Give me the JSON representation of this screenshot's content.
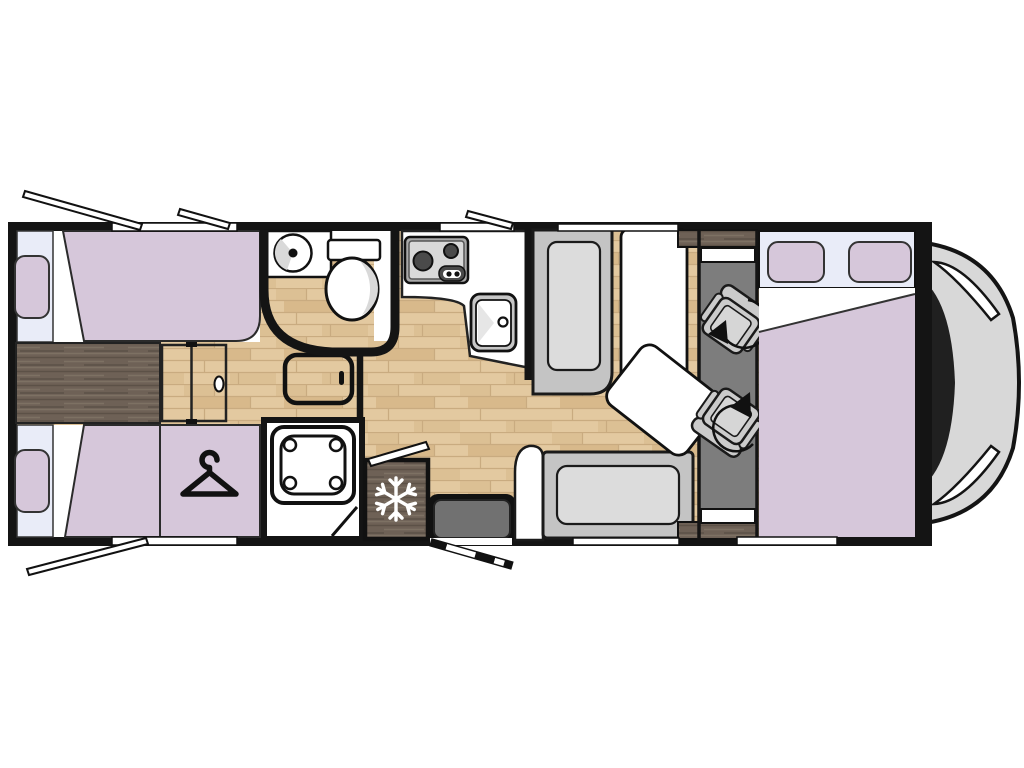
{
  "diagram": {
    "type": "motorhome-floor-plan",
    "view": "top-down",
    "vehicle_front": "right"
  },
  "colors": {
    "wall": "#141414",
    "fixture-white": "#ffffff",
    "upholstery-lavender": "#d6c7da",
    "window-pane": "#e9ecf8",
    "wood-light": "#e3c9a0",
    "wood-light-streak": "#d8b98b",
    "wood-light-streak2": "#dcc094",
    "wood-light-line": "#c9ab80",
    "wood-dark": "#6e6156",
    "wood-dark-grain-light": "#7d7163",
    "wood-dark-grain-dark": "#5c5147",
    "bench-gray": "#c4c4c4",
    "cushion-gray": "#dcdcdc",
    "cab-floor-gray": "#7d7d7d",
    "seat-gray": "#cbcbcb",
    "step-gray": "#717171",
    "appliance-dark": "#4a4a4a",
    "appliance-frame": "#a9a9a9",
    "sink-rim": "#c6c6c6",
    "vehicle-body": "#d8d8d8",
    "windshield": "#202020"
  },
  "icons": {
    "snowflake-icon": "❄",
    "hanger-icon": "⌥",
    "rotation-arrow-icon": "↻",
    "burner-icon": "●",
    "faucet-icon": "○",
    "open-window-flap-icon": "⟋",
    "headlight-icon": "⟋"
  },
  "rooms": [
    "rear-twin-bedroom",
    "wardrobe",
    "bathroom",
    "shower",
    "corridor-sliding-door",
    "kitchen",
    "fridge",
    "entrance",
    "dinette",
    "cab-swivel-seats",
    "front-bed",
    "cab-nose"
  ]
}
